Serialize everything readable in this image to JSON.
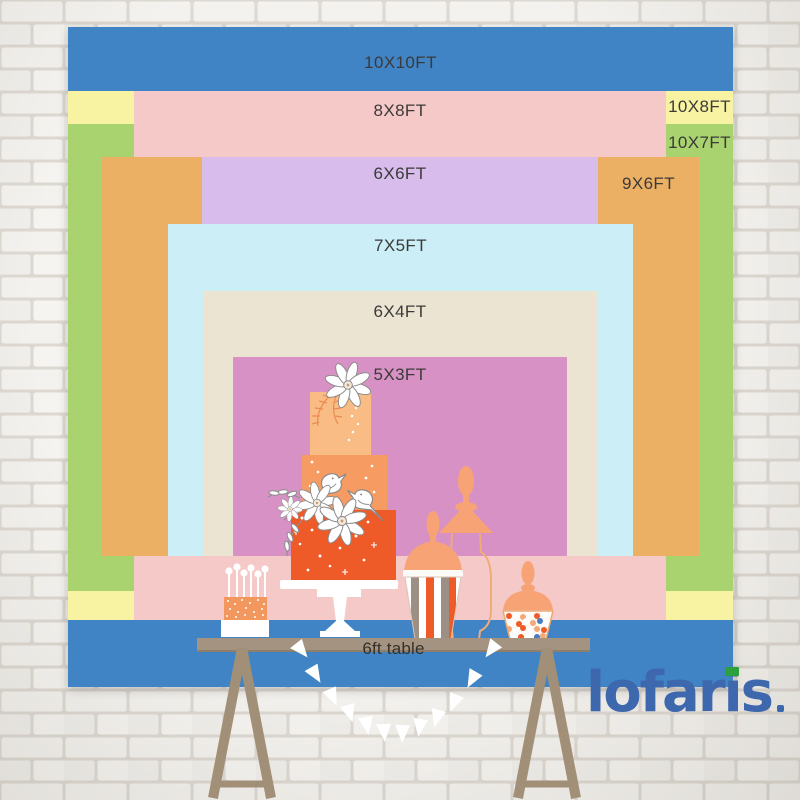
{
  "backdrop": {
    "sizes": [
      {
        "id": "10x10",
        "label": "10X10FT",
        "color": "#4184c6"
      },
      {
        "id": "10x8",
        "label": "10X8FT",
        "color": "#f8f3a2"
      },
      {
        "id": "10x7",
        "label": "10X7FT",
        "color": "#a9d36e"
      },
      {
        "id": "8x8",
        "label": "8X8FT",
        "color": "#f6c9c9"
      },
      {
        "id": "9x6",
        "label": "9X6FT",
        "color": "#ecb065"
      },
      {
        "id": "6x6",
        "label": "6X6FT",
        "color": "#d7bcec"
      },
      {
        "id": "7x5",
        "label": "7X5FT",
        "color": "#cbeef7"
      },
      {
        "id": "6x4",
        "label": "6X4FT",
        "color": "#ebe4d2"
      },
      {
        "id": "5x3",
        "label": "5X3FT",
        "color": "#d791c4"
      }
    ]
  },
  "table": {
    "label": "6ft table",
    "color": "#a59381"
  },
  "logo": {
    "text": "lofaris",
    "color": "#3e68ae",
    "accent_color": "#2ba03c"
  }
}
